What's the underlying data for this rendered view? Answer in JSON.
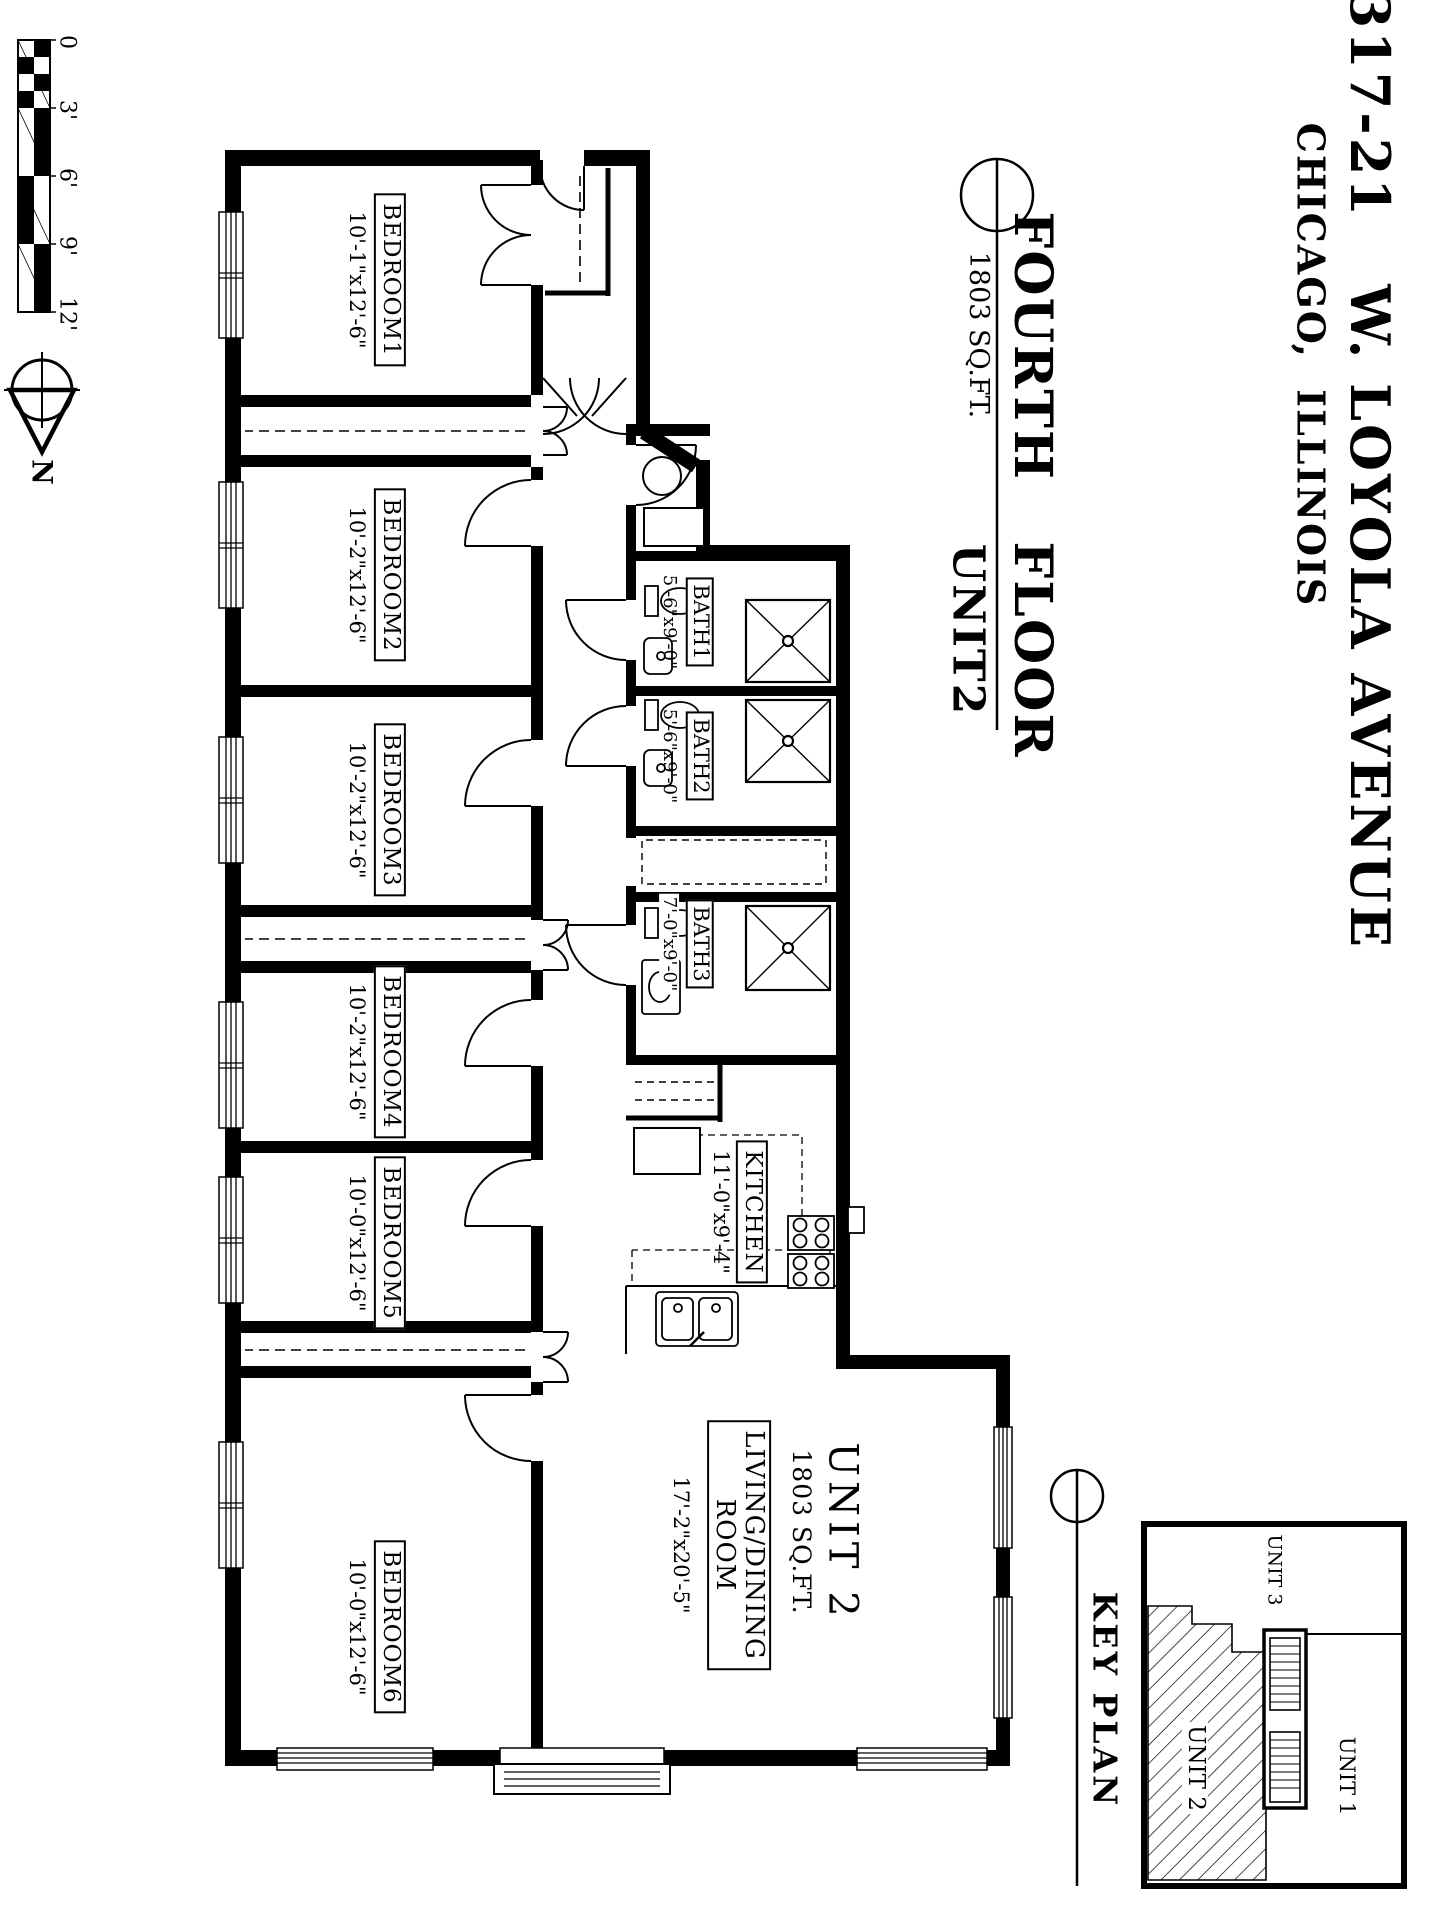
{
  "sheet": {
    "address": "1317-21   W. LOYOLA AVENUE",
    "city": "CHICAGO,  ILLINOIS",
    "floor_title": "FOURTH   FLOOR",
    "floor_area": "1803 SQ.FT.",
    "floor_unit": "UNIT2"
  },
  "plan": {
    "bedrooms": [
      {
        "name": "BEDROOM1",
        "dims": "10'-1\"x12'-6\""
      },
      {
        "name": "BEDROOM2",
        "dims": "10'-2\"x12'-6\""
      },
      {
        "name": "BEDROOM3",
        "dims": "10'-2\"x12'-6\""
      },
      {
        "name": "BEDROOM4",
        "dims": "10'-2\"x12'-6\""
      },
      {
        "name": "BEDROOM5",
        "dims": "10'-0\"x12'-6\""
      },
      {
        "name": "BEDROOM6",
        "dims": "10'-0\"x12'-6\""
      }
    ],
    "baths": [
      {
        "name": "BATH1",
        "dims": "5'-6\"x9'-0\""
      },
      {
        "name": "BATH2",
        "dims": "5'-6\"x9'-0\""
      },
      {
        "name": "BATH3",
        "dims": "7'-0\"x9'-0\""
      }
    ],
    "kitchen": {
      "name": "KITCHEN",
      "dims": "11'-0\"x9'-4\""
    },
    "living": {
      "line1": "LIVING/DINING",
      "line2": "ROOM",
      "dims": "17'-2\"x20'-5\""
    },
    "unit": {
      "name": "UNIT 2",
      "area": "1803 SQ.FT."
    }
  },
  "key_plan": {
    "title": "KEY PLAN",
    "unit1": "UNIT 1",
    "unit2": "UNIT 2",
    "unit3": "UNIT 3"
  },
  "scale_bar": {
    "labels": [
      "0",
      "3'",
      "6'",
      "9'",
      "12'"
    ]
  },
  "compass": {
    "north": "N"
  }
}
